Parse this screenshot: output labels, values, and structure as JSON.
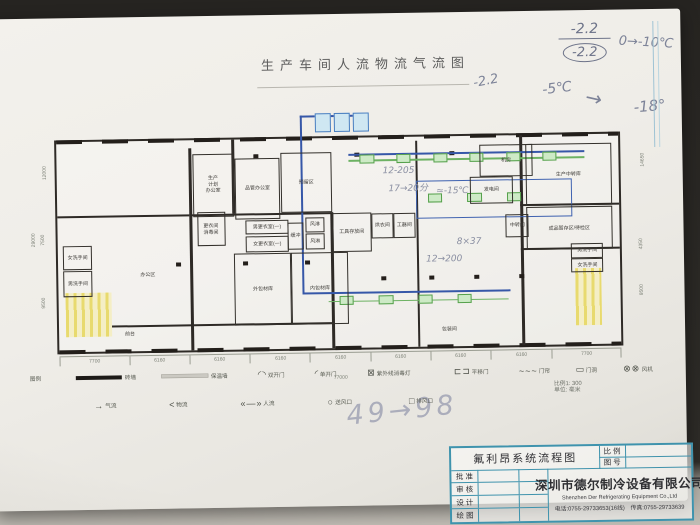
{
  "title": "生产车间人流物流气流图",
  "handwritten": {
    "fraction_top": "-2.2",
    "fraction_bottom": "-2.2",
    "temp_range": "0→-10℃",
    "left_temp": "-2.2",
    "from_temp": "-5℃",
    "arrow": "→",
    "to_temp": "-18°",
    "bottom_note": "49→98",
    "plan_note_1": "12-205",
    "plan_note_2": "17→20分",
    "plan_note_3": "8×37",
    "plan_note_4": "12→200",
    "plan_note_5": "≈-15℃"
  },
  "plan": {
    "rooms": [
      {
        "label": "生产\n计划\n办公室",
        "x": 24.2,
        "y": 6.5,
        "w": 7,
        "h": 29,
        "border": true
      },
      {
        "label": "更衣间\n消毒间",
        "x": 24.9,
        "y": 34.5,
        "w": 4.6,
        "h": 15,
        "border": true
      },
      {
        "label": "办公区",
        "x": 6,
        "y": 50,
        "w": 20,
        "h": 28,
        "border": false
      },
      {
        "label": "女洗手间",
        "x": 0.9,
        "y": 49.5,
        "w": 4.8,
        "h": 10.5,
        "border": true
      },
      {
        "label": "男洗手间",
        "x": 0.9,
        "y": 61.5,
        "w": 4.8,
        "h": 11.5,
        "border": true
      },
      {
        "label": "前台",
        "x": 10.3,
        "y": 88,
        "w": 4.5,
        "h": 8,
        "border": false
      },
      {
        "label": "品管办公室",
        "x": 31.7,
        "y": 9,
        "w": 7.7,
        "h": 28,
        "border": true
      },
      {
        "label": "预留区",
        "x": 39.8,
        "y": 6.5,
        "w": 8.8,
        "h": 28,
        "border": true
      },
      {
        "label": "男更衣室(一)",
        "x": 33.5,
        "y": 38.5,
        "w": 7.2,
        "h": 6,
        "border": true
      },
      {
        "label": "女更衣室(一)",
        "x": 33.5,
        "y": 46,
        "w": 7.2,
        "h": 7,
        "border": true
      },
      {
        "label": "缓冲",
        "x": 41,
        "y": 40,
        "w": 2.4,
        "h": 12,
        "border": true
      },
      {
        "label": "风淋",
        "x": 44.2,
        "y": 37.5,
        "w": 3,
        "h": 6.5,
        "border": true
      },
      {
        "label": "风淋",
        "x": 44.2,
        "y": 45,
        "w": 3,
        "h": 7,
        "border": true
      },
      {
        "label": "外包材库",
        "x": 31.3,
        "y": 54.5,
        "w": 9.8,
        "h": 33,
        "border": true
      },
      {
        "label": "内包材库",
        "x": 41.5,
        "y": 54.5,
        "w": 9.8,
        "h": 33,
        "border": true
      },
      {
        "label": "工具存放间",
        "x": 49,
        "y": 35.5,
        "w": 6.5,
        "h": 18,
        "border": true
      },
      {
        "label": "烘衣间",
        "x": 55.8,
        "y": 36,
        "w": 3.7,
        "h": 11,
        "border": true
      },
      {
        "label": "工器间",
        "x": 59.7,
        "y": 36,
        "w": 3.7,
        "h": 11,
        "border": true
      },
      {
        "label": "机房",
        "x": 75.3,
        "y": 4.3,
        "w": 9,
        "h": 14.5,
        "border": true
      },
      {
        "label": "发电间",
        "x": 73.5,
        "y": 19.5,
        "w": 7.2,
        "h": 12,
        "border": true
      },
      {
        "label": "生产中转库",
        "x": 83.4,
        "y": 4.3,
        "w": 15,
        "h": 28.5,
        "border": true
      },
      {
        "label": "成品暂存区/待检区",
        "x": 83.4,
        "y": 34.5,
        "w": 15,
        "h": 19.5,
        "border": true
      },
      {
        "label": "中转间",
        "x": 79.8,
        "y": 37.5,
        "w": 3.7,
        "h": 10,
        "border": true
      },
      {
        "label": "包装间",
        "x": 66,
        "y": 88,
        "w": 7,
        "h": 8,
        "border": false
      },
      {
        "label": "男洗手间",
        "x": 91.3,
        "y": 52,
        "w": 5.4,
        "h": 6,
        "border": true
      },
      {
        "label": "女洗手间",
        "x": 91.3,
        "y": 59,
        "w": 5.4,
        "h": 6,
        "border": true
      }
    ],
    "dim_bottom": [
      "7700",
      "6160",
      "6160",
      "6160",
      "6160",
      "6160",
      "6160",
      "6160",
      "7700"
    ],
    "dim_total": "77000",
    "dim_left": [
      "12000",
      "7500",
      "9500"
    ],
    "dim_left_total": "29000",
    "dim_right": [
      "14650",
      "4350",
      "9500"
    ]
  },
  "legend": {
    "label": "图例",
    "row1": [
      {
        "label": "砖墙",
        "cls": "thick",
        "sym": ""
      },
      {
        "label": "保温墙",
        "cls": "ins",
        "sym": ""
      },
      {
        "label": "双开门",
        "sym": "◜◝"
      },
      {
        "label": "单开门",
        "sym": "◜"
      },
      {
        "label": "紫外线消毒灯",
        "sym": "⊠"
      },
      {
        "label": "平移门",
        "sym": "⊏⊐"
      },
      {
        "label": "门帘",
        "sym": "~~~"
      },
      {
        "label": "门洞",
        "sym": "▭"
      },
      {
        "label": "风机",
        "sym": "⊗⊗"
      }
    ],
    "row2": [
      {
        "label": "气流",
        "sym": "→"
      },
      {
        "label": "物流",
        "sym": "<"
      },
      {
        "label": "人流",
        "sym": "«—»"
      },
      {
        "label": "送风口",
        "sym": "○"
      },
      {
        "label": "排风口",
        "sym": "□"
      }
    ],
    "scale": "比例1: 300",
    "unit": "单位: 毫米"
  },
  "titleblock": {
    "drawing_title": "氟利昂系统流程图",
    "scale_label": "比 例",
    "number_label": "图 号",
    "rows": [
      "批 准",
      "审 核",
      "设 计",
      "绘 图"
    ],
    "company_cn": "深圳市德尔制冷设备有限公司",
    "company_en": "Shenzhen Der Refrigerating Equipment Co.,Ltd",
    "contact": "电话:0755-29733653(16线)　传真:0755-29733639"
  }
}
